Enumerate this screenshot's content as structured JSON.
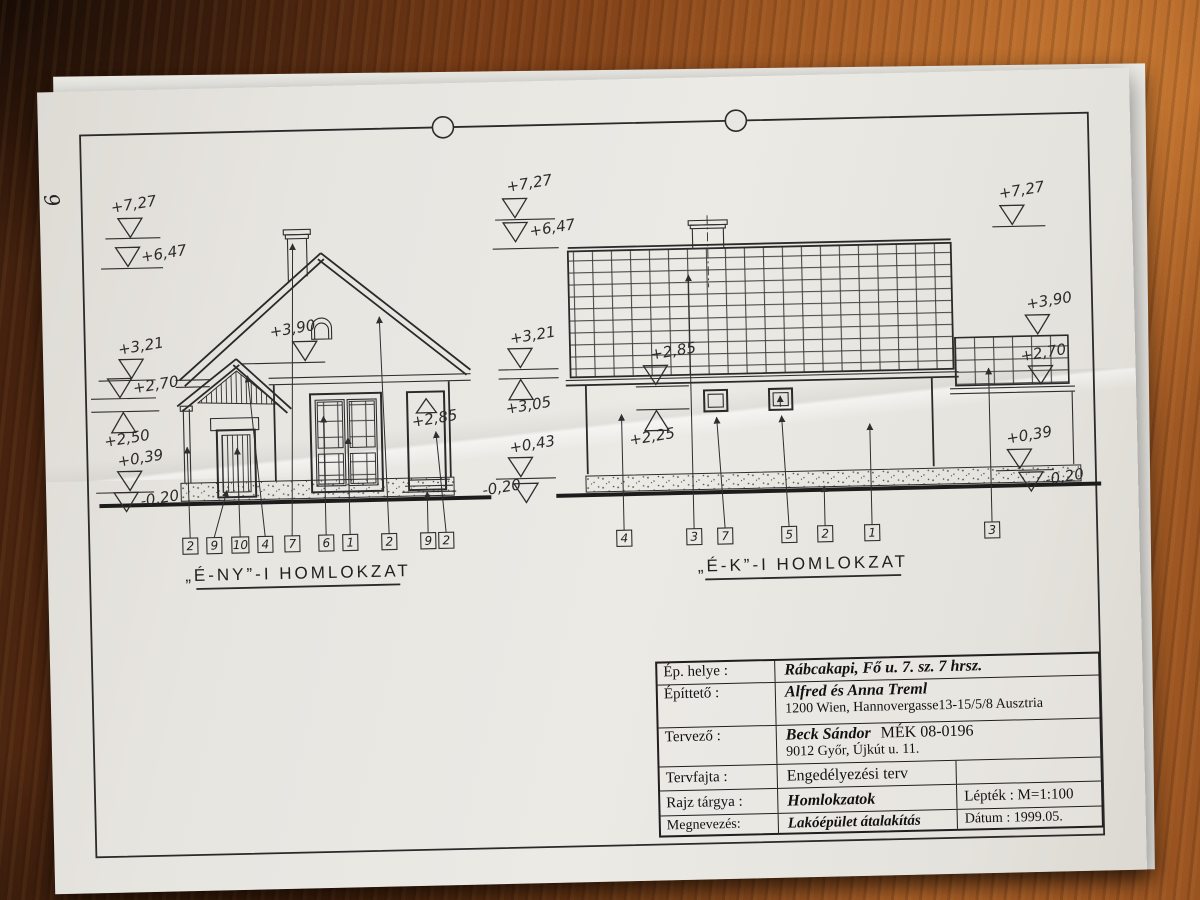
{
  "colors": {
    "wood_dark": "#3c1e0d",
    "wood_light": "#a95f27",
    "paper": "#e7e5e0",
    "ink": "#2b2b2b"
  },
  "page": {
    "side_number": "9"
  },
  "drawing_left": {
    "title": "„É-NY”-I HOMLOKZAT",
    "levels": [
      "+7,27",
      "+6,47",
      "+3,21",
      "+2,70",
      "+2,50",
      "+0,39",
      "-0,20"
    ],
    "roof_level": "+3,90",
    "door_level": "+2,85",
    "ref_numbers": [
      "2",
      "9",
      "10",
      "4",
      "7",
      "6",
      "1",
      "2",
      "9",
      "2"
    ]
  },
  "drawing_right": {
    "title": "„É-K”-I HOMLOKZAT",
    "levels_left": [
      "+7,27",
      "+6,47",
      "+3,21",
      "+3,05",
      "+0,43",
      "-0,20"
    ],
    "levels_inner": [
      "+2,85",
      "+2,25"
    ],
    "levels_right": [
      "+7,27",
      "+3,90",
      "+2,70",
      "+0,39",
      "-0,20"
    ],
    "ref_numbers": [
      "4",
      "3",
      "7",
      "5",
      "2",
      "1",
      "3"
    ]
  },
  "title_block": {
    "rows": [
      {
        "label": "Ép. helye :",
        "value": "Rábcakapi, Fő u. 7. sz. 7 hrsz."
      },
      {
        "label": "Építtető :",
        "value": "Alfred és Anna  Treml",
        "value2": "1200 Wien, Hannovergasse13-15/5/8  Ausztria"
      },
      {
        "label": "Tervező :",
        "value": "Beck Sándor",
        "value_note": "MÉK 08-0196",
        "value2": "9012 Győr, Újkút u. 11."
      },
      {
        "label": "Tervfajta :",
        "value": "Engedélyezési terv",
        "aux": ""
      },
      {
        "label": "Rajz tárgya :",
        "value": "Homlokzatok",
        "aux": "Lépték : M=1:100"
      },
      {
        "label": "Megnevezés:",
        "value": "Lakóépület átalakítás",
        "aux": "Dátum : 1999.05."
      }
    ]
  }
}
